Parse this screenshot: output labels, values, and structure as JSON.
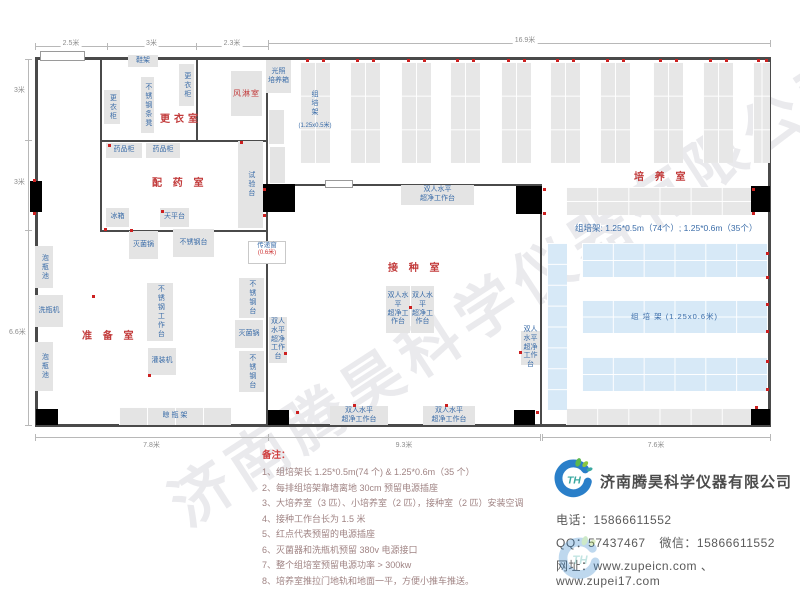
{
  "watermark": "济南腾昊科学仪器有限公司",
  "plan": {
    "walls": [
      {
        "x": 35,
        "y": 57,
        "w": 736,
        "h": 3
      },
      {
        "x": 35,
        "y": 424,
        "w": 736,
        "h": 3
      },
      {
        "x": 35,
        "y": 57,
        "w": 3,
        "h": 370
      },
      {
        "x": 768,
        "y": 57,
        "w": 3,
        "h": 370
      },
      {
        "x": 100,
        "y": 59,
        "w": 2,
        "h": 173
      },
      {
        "x": 196,
        "y": 59,
        "w": 2,
        "h": 82
      },
      {
        "x": 266,
        "y": 59,
        "w": 2,
        "h": 366
      },
      {
        "x": 100,
        "y": 140,
        "w": 168,
        "h": 2
      },
      {
        "x": 100,
        "y": 230,
        "w": 168,
        "h": 2
      },
      {
        "x": 266,
        "y": 184,
        "w": 276,
        "h": 2
      },
      {
        "x": 540,
        "y": 184,
        "w": 2,
        "h": 241
      }
    ],
    "doors": [
      {
        "x": 30,
        "y": 181,
        "w": 12,
        "h": 31
      },
      {
        "x": 36,
        "y": 409,
        "w": 22,
        "h": 16
      },
      {
        "x": 263,
        "y": 184,
        "w": 32,
        "h": 28
      },
      {
        "x": 268,
        "y": 410,
        "w": 21,
        "h": 15
      },
      {
        "x": 514,
        "y": 410,
        "w": 21,
        "h": 15
      },
      {
        "x": 516,
        "y": 186,
        "w": 26,
        "h": 28
      },
      {
        "x": 751,
        "y": 186,
        "w": 19,
        "h": 26
      },
      {
        "x": 751,
        "y": 409,
        "w": 19,
        "h": 16
      }
    ],
    "windows": [
      {
        "x": 40,
        "y": 51,
        "w": 45,
        "h": 10
      },
      {
        "x": 325,
        "y": 180,
        "w": 28,
        "h": 8
      }
    ],
    "room_labels": [
      {
        "x": 160,
        "y": 110,
        "text": "更衣室"
      },
      {
        "x": 152,
        "y": 174,
        "text": "配 药 室"
      },
      {
        "x": 634,
        "y": 168,
        "text": "培 养 室"
      },
      {
        "x": 388,
        "y": 259,
        "text": "接 种 室"
      },
      {
        "x": 82,
        "y": 327,
        "text": "准 备 室"
      }
    ],
    "equipment": [
      {
        "x": 128,
        "y": 55,
        "w": 30,
        "h": 12,
        "label": "鞋架"
      },
      {
        "x": 179,
        "y": 64,
        "w": 15,
        "h": 42,
        "label": "更衣柜",
        "v": true
      },
      {
        "x": 141,
        "y": 77,
        "w": 13,
        "h": 56,
        "label": "不锈钢条凳",
        "v": true
      },
      {
        "x": 104,
        "y": 90,
        "w": 16,
        "h": 34,
        "label": "更衣柜",
        "v": true
      },
      {
        "x": 231,
        "y": 71,
        "w": 31,
        "h": 45,
        "label": "风淋室",
        "red": true
      },
      {
        "x": 266,
        "y": 60,
        "w": 25,
        "h": 33,
        "label": "光照\n培养箱"
      },
      {
        "x": 269,
        "y": 110,
        "w": 15,
        "h": 34,
        "label": ""
      },
      {
        "x": 270,
        "y": 147,
        "w": 15,
        "h": 36,
        "label": ""
      },
      {
        "x": 106,
        "y": 143,
        "w": 36,
        "h": 15,
        "label": "药品柜"
      },
      {
        "x": 146,
        "y": 143,
        "w": 34,
        "h": 15,
        "label": "药品柜"
      },
      {
        "x": 106,
        "y": 208,
        "w": 23,
        "h": 19,
        "label": "冰箱"
      },
      {
        "x": 160,
        "y": 208,
        "w": 29,
        "h": 19,
        "label": "天平台"
      },
      {
        "x": 238,
        "y": 141,
        "w": 25,
        "h": 87,
        "label": "试验台",
        "v": true
      },
      {
        "x": 129,
        "y": 231,
        "w": 29,
        "h": 28,
        "label": "灭菌锅"
      },
      {
        "x": 173,
        "y": 229,
        "w": 41,
        "h": 28,
        "label": "不锈钢台"
      },
      {
        "x": 35,
        "y": 246,
        "w": 18,
        "h": 42,
        "label": "泡瓶池",
        "v": true
      },
      {
        "x": 35,
        "y": 295,
        "w": 28,
        "h": 32,
        "label": "洗瓶机"
      },
      {
        "x": 35,
        "y": 342,
        "w": 18,
        "h": 49,
        "label": "泡瓶池",
        "v": true
      },
      {
        "x": 147,
        "y": 283,
        "w": 26,
        "h": 58,
        "label": "不锈钢工作台",
        "v": true
      },
      {
        "x": 148,
        "y": 348,
        "w": 28,
        "h": 27,
        "label": "灌装机"
      },
      {
        "x": 239,
        "y": 278,
        "w": 25,
        "h": 40,
        "label": "不锈钢台",
        "v": true
      },
      {
        "x": 235,
        "y": 320,
        "w": 28,
        "h": 28,
        "label": "灭菌锅"
      },
      {
        "x": 239,
        "y": 351,
        "w": 25,
        "h": 41,
        "label": "不锈钢台",
        "v": true
      },
      {
        "x": 119,
        "y": 407,
        "w": 112,
        "h": 18,
        "label": "晾 瓶 架",
        "grid": true,
        "cols": 4,
        "rows": 1
      },
      {
        "x": 386,
        "y": 286,
        "w": 24,
        "h": 47,
        "label": "双人水平\n超净工作台"
      },
      {
        "x": 411,
        "y": 286,
        "w": 23,
        "h": 47,
        "label": "双人水平\n超净工作台"
      },
      {
        "x": 269,
        "y": 317,
        "w": 18,
        "h": 46,
        "label": "双人水平\n超净工作台"
      },
      {
        "x": 521,
        "y": 331,
        "w": 19,
        "h": 34,
        "label": "双人水平\n超净工作台"
      },
      {
        "x": 330,
        "y": 406,
        "w": 58,
        "h": 19,
        "label": "双人水平\n超净工作台"
      },
      {
        "x": 423,
        "y": 406,
        "w": 52,
        "h": 19,
        "label": "双人水平\n超净工作台"
      },
      {
        "x": 401,
        "y": 185,
        "w": 73,
        "h": 20,
        "label": "双人水平\n超净工作台"
      }
    ],
    "culture_racks": [
      {
        "x": 300,
        "y": 62,
        "w": 30,
        "h": 101
      },
      {
        "x": 350,
        "y": 62,
        "w": 30,
        "h": 101
      },
      {
        "x": 401,
        "y": 62,
        "w": 30,
        "h": 101
      },
      {
        "x": 450,
        "y": 62,
        "w": 30,
        "h": 101
      },
      {
        "x": 501,
        "y": 62,
        "w": 30,
        "h": 101
      },
      {
        "x": 550,
        "y": 62,
        "w": 30,
        "h": 101
      },
      {
        "x": 600,
        "y": 62,
        "w": 30,
        "h": 101
      },
      {
        "x": 653,
        "y": 62,
        "w": 30,
        "h": 101
      },
      {
        "x": 703,
        "y": 62,
        "w": 30,
        "h": 101
      },
      {
        "x": 753,
        "y": 62,
        "w": 17,
        "h": 101
      }
    ],
    "gray_racks": [
      {
        "x": 566,
        "y": 187,
        "w": 187,
        "h": 28,
        "cols": 6,
        "rows": 2
      },
      {
        "x": 566,
        "y": 408,
        "w": 187,
        "h": 17,
        "cols": 6,
        "rows": 1
      }
    ],
    "blue_racks": [
      {
        "x": 547,
        "y": 243,
        "w": 20,
        "h": 167,
        "cols": 1,
        "rows": 8,
        "label": ""
      },
      {
        "x": 582,
        "y": 243,
        "w": 185,
        "h": 34,
        "cols": 6,
        "rows": 2,
        "label": ""
      },
      {
        "x": 582,
        "y": 300,
        "w": 185,
        "h": 33,
        "cols": 6,
        "rows": 2,
        "label": "组  培  架 (1.25x0.6米)"
      },
      {
        "x": 582,
        "y": 357,
        "w": 185,
        "h": 34,
        "cols": 6,
        "rows": 2,
        "label": ""
      }
    ],
    "rack_label": {
      "x": 296,
      "y": 90,
      "chars": "组\n培\n架",
      "sub": "(1.25x0.5米)"
    },
    "rack_spec": {
      "x": 575,
      "y": 222,
      "text": "组培架: 1.25*0.5m（74个）; 1.25*0.6m（35个）"
    },
    "transfer_window": {
      "x": 248,
      "y": 241,
      "w": 36,
      "h": 21,
      "label": "传递窗",
      "sub": "(0.6米)"
    },
    "dots": [
      {
        "x": 306,
        "y": 59
      },
      {
        "x": 322,
        "y": 59
      },
      {
        "x": 356,
        "y": 59
      },
      {
        "x": 372,
        "y": 59
      },
      {
        "x": 407,
        "y": 59
      },
      {
        "x": 423,
        "y": 59
      },
      {
        "x": 456,
        "y": 59
      },
      {
        "x": 472,
        "y": 59
      },
      {
        "x": 507,
        "y": 59
      },
      {
        "x": 523,
        "y": 59
      },
      {
        "x": 556,
        "y": 59
      },
      {
        "x": 572,
        "y": 59
      },
      {
        "x": 606,
        "y": 59
      },
      {
        "x": 622,
        "y": 59
      },
      {
        "x": 659,
        "y": 59
      },
      {
        "x": 675,
        "y": 59
      },
      {
        "x": 709,
        "y": 59
      },
      {
        "x": 725,
        "y": 59
      },
      {
        "x": 757,
        "y": 59
      },
      {
        "x": 765,
        "y": 59
      },
      {
        "x": 33,
        "y": 179
      },
      {
        "x": 33,
        "y": 212
      },
      {
        "x": 92,
        "y": 295
      },
      {
        "x": 104,
        "y": 228
      },
      {
        "x": 130,
        "y": 229
      },
      {
        "x": 161,
        "y": 210
      },
      {
        "x": 108,
        "y": 144
      },
      {
        "x": 240,
        "y": 141
      },
      {
        "x": 263,
        "y": 188
      },
      {
        "x": 263,
        "y": 214
      },
      {
        "x": 409,
        "y": 306
      },
      {
        "x": 284,
        "y": 352
      },
      {
        "x": 519,
        "y": 351
      },
      {
        "x": 148,
        "y": 374
      },
      {
        "x": 353,
        "y": 404
      },
      {
        "x": 445,
        "y": 404
      },
      {
        "x": 296,
        "y": 411
      },
      {
        "x": 536,
        "y": 411
      },
      {
        "x": 543,
        "y": 188
      },
      {
        "x": 543,
        "y": 212
      },
      {
        "x": 752,
        "y": 188
      },
      {
        "x": 752,
        "y": 212
      },
      {
        "x": 766,
        "y": 252
      },
      {
        "x": 766,
        "y": 276
      },
      {
        "x": 766,
        "y": 303
      },
      {
        "x": 766,
        "y": 330
      },
      {
        "x": 766,
        "y": 360
      },
      {
        "x": 766,
        "y": 388
      },
      {
        "x": 755,
        "y": 406
      }
    ],
    "dims_h": [
      {
        "x1": 35,
        "x2": 107,
        "y": 46,
        "label": "2.5米",
        "ly": 38
      },
      {
        "x1": 107,
        "x2": 196,
        "y": 46,
        "label": "3米",
        "ly": 38
      },
      {
        "x1": 196,
        "x2": 268,
        "y": 46,
        "label": "2.3米",
        "ly": 38
      },
      {
        "x1": 268,
        "x2": 770,
        "y": 43,
        "label": "16.9米",
        "lx": 525,
        "ly": 35
      },
      {
        "x1": 35,
        "x2": 268,
        "y": 437,
        "label": "7.8米",
        "ly": 440
      },
      {
        "x1": 268,
        "x2": 540,
        "y": 437,
        "label": "9.3米",
        "ly": 440
      },
      {
        "x1": 542,
        "x2": 770,
        "y": 437,
        "label": "7.6米",
        "ly": 440
      }
    ],
    "dims_v": [
      {
        "x": 28,
        "y1": 59,
        "y2": 140,
        "label": "3米",
        "lx": 12,
        "ly": 85
      },
      {
        "x": 28,
        "y1": 140,
        "y2": 230,
        "label": "3米",
        "lx": 12,
        "ly": 177
      },
      {
        "x": 28,
        "y1": 230,
        "y2": 425,
        "label": "6.6米",
        "lx": 7,
        "ly": 327
      }
    ]
  },
  "notes": {
    "header": "备注：",
    "items": [
      "1、组培架长 1.25*0.5m(74 个) & 1.25*0.6m（35 个）",
      "2、每排组培架靠墙离地 30cm 预留电源插座",
      "3、大培养室（3 匹）、小培养室（2 匹），接种室（2 匹）安装空调",
      "4、接种工作台长为 1.5 米",
      "5、红点代表预留的电源插座",
      "6、灭菌器和洗瓶机预留 380v 电源接口",
      "7、整个组培室预留电源功率 > 300kw",
      "8、培养室推拉门地轨和地面一平，方便小推车推送。"
    ]
  },
  "company": {
    "name": "济南腾昊科学仪器有限公司",
    "phone_label": "电话：",
    "phone": "15866611552",
    "qq_label": "QQ：",
    "qq": "57437467",
    "wechat_label": "微信：",
    "wechat": "15866611552",
    "web_label": "网址：",
    "web": "www.zupeicn.com 、www.zupei17.com"
  },
  "colors": {
    "wall": "#4a4a4a",
    "equipment_fill": "#e4e4e4",
    "blue_rack_fill": "#d7e9f7",
    "room_label": "#c23b3b",
    "equipment_label": "#3a6ca8",
    "power_dot": "#cc2020",
    "logo_blue": "#2a7fc9",
    "logo_green": "#5cb84d"
  }
}
